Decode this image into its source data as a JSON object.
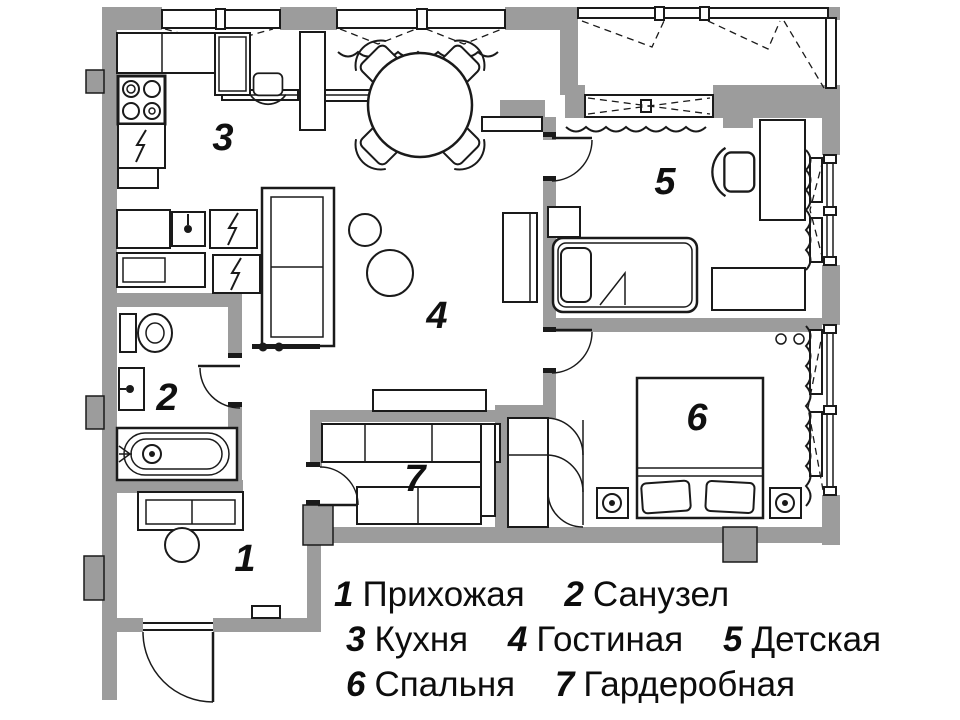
{
  "plan": {
    "title_hint": "apartment floor plan",
    "rooms": [
      {
        "number": "1",
        "name": "Прихожая"
      },
      {
        "number": "2",
        "name": "Санузел"
      },
      {
        "number": "3",
        "name": "Кухня"
      },
      {
        "number": "4",
        "name": "Гостиная"
      },
      {
        "number": "5",
        "name": "Детская"
      },
      {
        "number": "6",
        "name": "Спальня"
      },
      {
        "number": "7",
        "name": "Гардеробная"
      }
    ],
    "colors": {
      "wall": "#9c9c9c",
      "line": "#1a1a1a",
      "background": "#ffffff"
    }
  }
}
